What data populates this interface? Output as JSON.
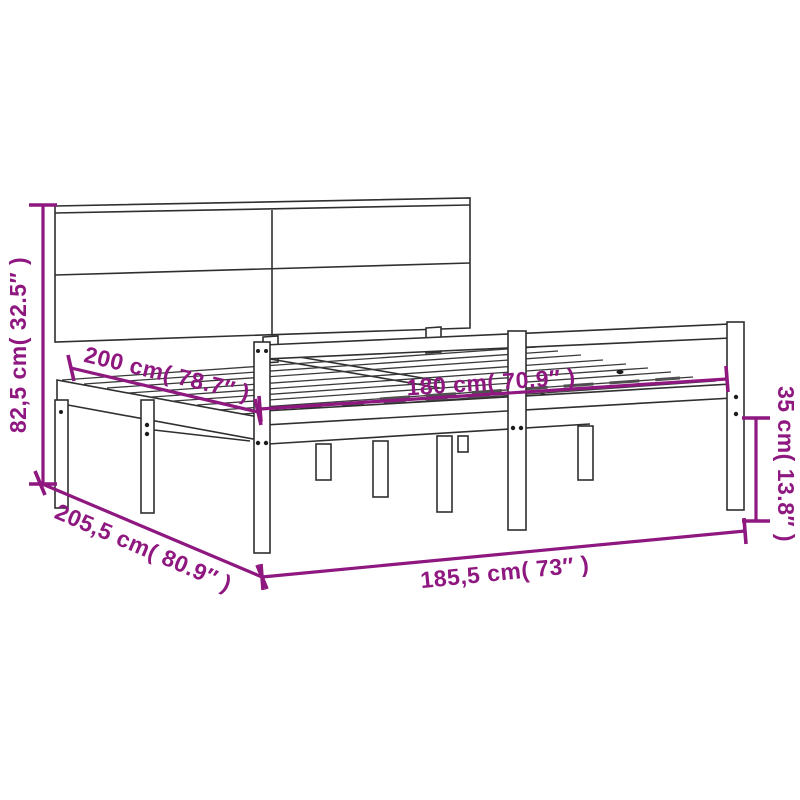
{
  "diagram": {
    "kind": "product-dimension-diagram",
    "subject": "bed-frame-with-headboard",
    "background_color": "#ffffff",
    "drawing_line_color": "#2f2f2f",
    "accent_color": "#8e1780",
    "dimensions": [
      {
        "id": "headboard-height",
        "cm": "82,5",
        "inches": "32.5",
        "label": "82,5 cm( 32.5″ )",
        "placement": "vertical-left"
      },
      {
        "id": "mattress-length",
        "cm": "200",
        "inches": "78.7",
        "label": "200 cm( 78.7″ )",
        "placement": "diagonal-upper-left"
      },
      {
        "id": "mattress-width",
        "cm": "180",
        "inches": "70.9",
        "label": "180 cm( 70.9″ )",
        "placement": "across-platform"
      },
      {
        "id": "platform-height",
        "cm": "35",
        "inches": "13.8",
        "label": "35 cm( 13.8″ )",
        "placement": "vertical-right"
      },
      {
        "id": "frame-length",
        "cm": "205,5",
        "inches": "80.9",
        "label": "205,5 cm( 80.9″ )",
        "placement": "diagonal-lower-left"
      },
      {
        "id": "frame-width",
        "cm": "185,5",
        "inches": "73",
        "label": "185,5 cm( 73″ )",
        "placement": "horizontal-bottom"
      }
    ]
  }
}
